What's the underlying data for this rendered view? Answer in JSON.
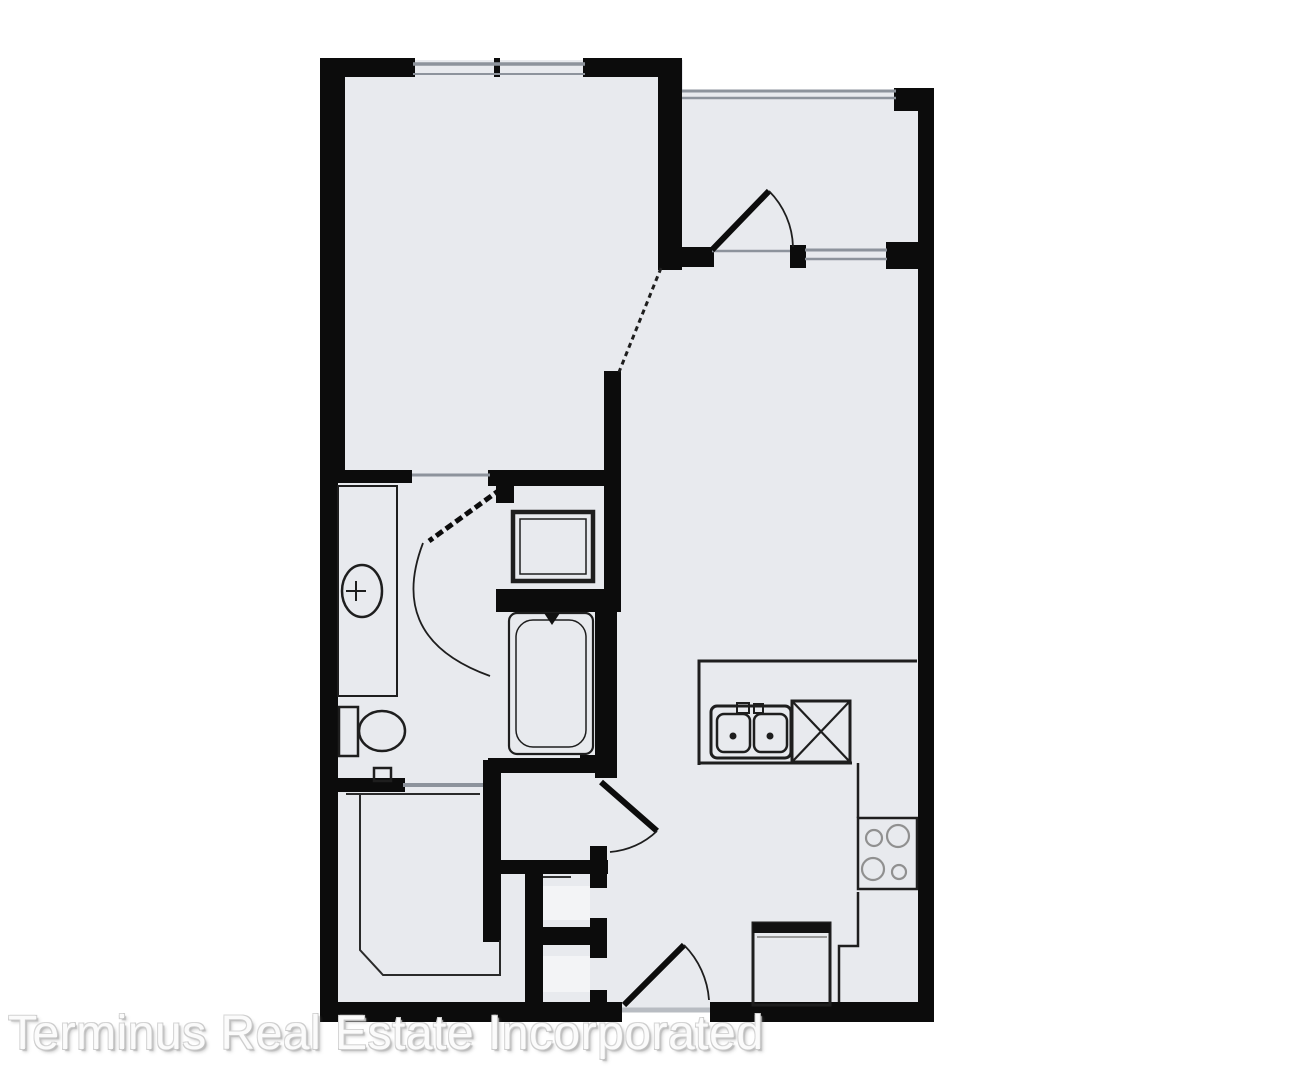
{
  "watermark": {
    "text": "Terminus Real Estate Incorporated"
  },
  "palette": {
    "background": "#ffffff",
    "room_fill": "#e8eaee",
    "niche_fill": "#f3f4f6",
    "wall": "#0c0c0c",
    "fixture_line": "#1e1e1e",
    "window_line": "#8d939c",
    "threshold_line": "#b8bcc2",
    "burner_line": "#909090",
    "watermark_text": "#fbfbfb",
    "watermark_emboss": "#c3c3c3"
  },
  "floor_plan": {
    "type": "apartment-floor-plan",
    "fixture_symbols": [
      "bedroom-window",
      "balcony-railing",
      "balcony-window",
      "balcony-swing-door",
      "bedroom-bathroom-swing-door",
      "hall-kitchen-swing-door",
      "entry-swing-door",
      "bathroom-vanity-counter",
      "oval-lavatory-sink",
      "toilet",
      "shower-stall",
      "bathtub",
      "walk-in-closet-shelving",
      "kitchen-counter",
      "double-basin-kitchen-sink",
      "dishwasher-x-box",
      "range-with-four-burners",
      "refrigerator",
      "laundry-niche-walls",
      "bedroom-opening-dashed-divider"
    ]
  }
}
